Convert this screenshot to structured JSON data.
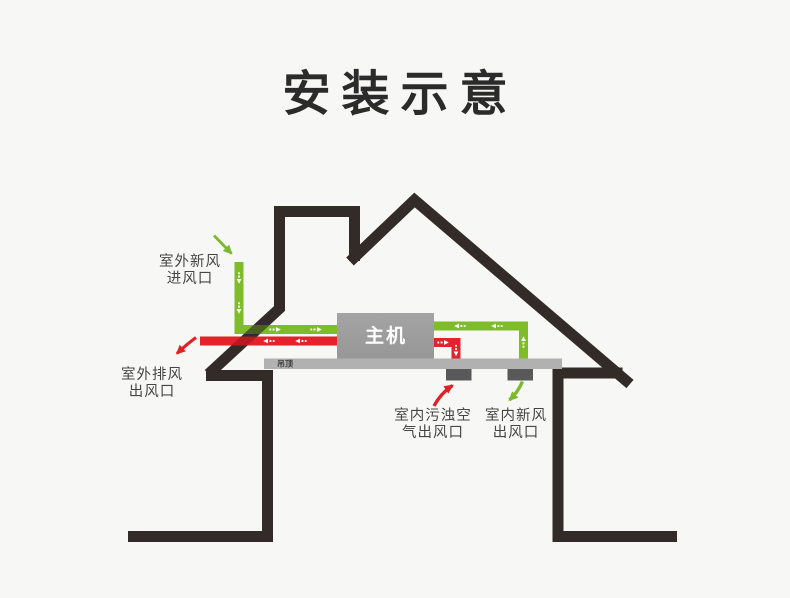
{
  "title": "安装示意",
  "diagram": {
    "main_unit_label": "主机",
    "ceiling_label": "吊顶",
    "callouts": {
      "outdoor_fresh_intake": {
        "line1": "室外新风",
        "line2": "进风口"
      },
      "outdoor_exhaust_outlet": {
        "line1": "室外排风",
        "line2": "出风口"
      },
      "indoor_exhaust_outlet": {
        "line1": "室内污浊空",
        "line2": "气出风口"
      },
      "indoor_fresh_outlet": {
        "line1": "室内新风",
        "line2": "出风口"
      }
    },
    "colors": {
      "fresh_air_green": "#7fbc2a",
      "exhaust_red": "#e3232a",
      "structure_black": "#332b28",
      "unit_gray": "#9e9e9e",
      "ceiling_gray": "#b1b1b1",
      "vent_gray": "#595959",
      "label_text": "#464646",
      "background": "#f7f7f5"
    }
  }
}
